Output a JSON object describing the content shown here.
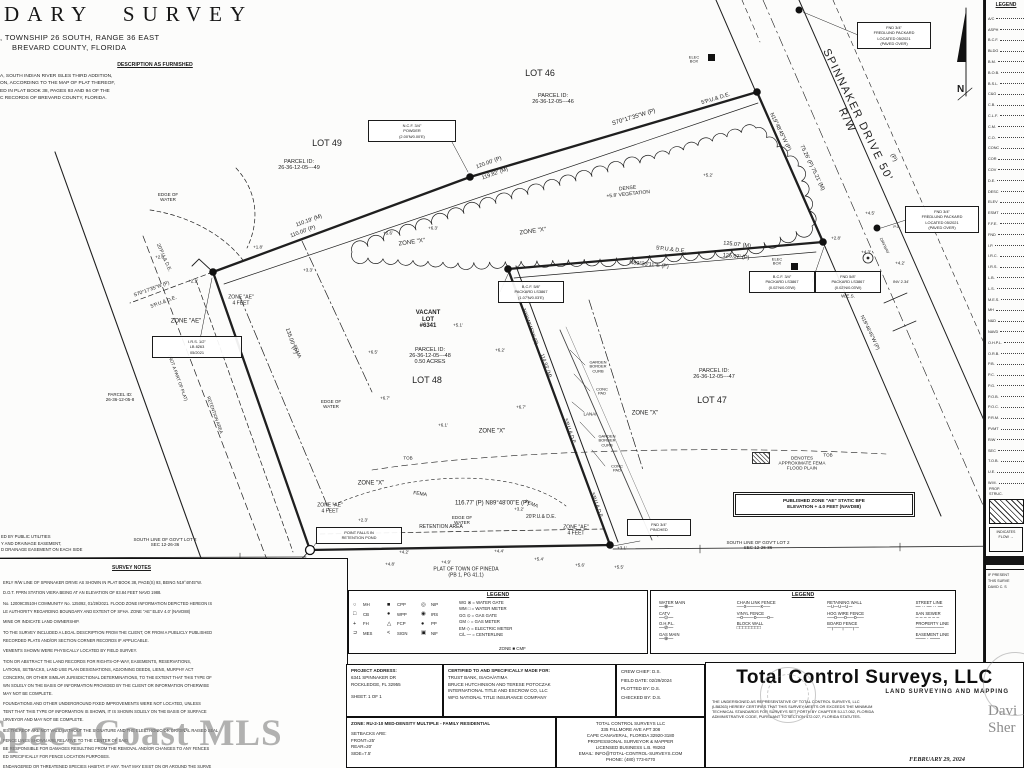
{
  "title_block": {
    "title": "DARY SURVEY",
    "line2": ", TOWNSHIP 26 SOUTH, RANGE 36 EAST",
    "line3": "BREVARD COUNTY, FLORIDA",
    "description_header": "DESCRIPTION AS FURNISHED",
    "description_lines": [
      "A, SOUTH INDIAN RIVER ISLES THIRD ADDITION,",
      "ON, ACCORDING TO THE MAP OF PLAT THEREOF,",
      "ED IN PLAT BOOK 38, PAGES 93 AND 94 OF THE",
      "C RECORDS OF BREVARD COUNTY, FLORIDA."
    ]
  },
  "easement_note_lines": [
    "ED BY PUBLIC UTILITIES",
    "Y AND DRAINAGE EASEMENT,",
    "D DRAINAGE EASEMENT ON EACH SIDE"
  ],
  "north_label": "N",
  "map": {
    "labels": [
      {
        "t": "LOT 46",
        "x": 540,
        "y": 73,
        "s": 9
      },
      {
        "t": "PARCEL ID:\n26-36-12-05---46",
        "x": 553,
        "y": 99,
        "s": 5.5
      },
      {
        "t": "LOT 49",
        "x": 327,
        "y": 143,
        "s": 9
      },
      {
        "t": "PARCEL ID:\n26-36-12-05---49",
        "x": 299,
        "y": 165,
        "s": 5.5
      },
      {
        "t": "LOT 48",
        "x": 427,
        "y": 380,
        "s": 9
      },
      {
        "t": "VACANT\nLOT\n#6341",
        "x": 428,
        "y": 320,
        "s": 6,
        "b": 1
      },
      {
        "t": "PARCEL ID:\n26-36-12-05---48\n0.50 ACRES",
        "x": 430,
        "y": 356,
        "s": 5.5
      },
      {
        "t": "LOT 47",
        "x": 712,
        "y": 400,
        "s": 9
      },
      {
        "t": "PARCEL ID:\n26-36-12-05---47",
        "x": 714,
        "y": 374,
        "s": 5.5
      },
      {
        "t": "SPINNAKER  DRIVE  50' R/W",
        "x": 852,
        "y": 118,
        "s": 11,
        "r": 64,
        "ls": 1.5
      },
      {
        "t": "(P)",
        "x": 893,
        "y": 158,
        "s": 6,
        "r": 64
      },
      {
        "t": "S70°17'35\"W  (P)",
        "x": 634,
        "y": 118,
        "s": 6,
        "r": -17
      },
      {
        "t": "5'P.U.& D.E.",
        "x": 716,
        "y": 99,
        "s": 5.5,
        "r": -17
      },
      {
        "t": "120.00' (P)",
        "x": 489,
        "y": 163,
        "s": 5.5,
        "r": -20
      },
      {
        "t": "119.82' (M)",
        "x": 495,
        "y": 174,
        "s": 5.5,
        "r": -20
      },
      {
        "t": "110.19' (M)",
        "x": 309,
        "y": 221,
        "s": 5.5,
        "r": -20
      },
      {
        "t": "110.00' (P)",
        "x": 303,
        "y": 232,
        "s": 5.5,
        "r": -20
      },
      {
        "t": "S70°17'35\"W (P)",
        "x": 152,
        "y": 290,
        "s": 5,
        "r": -20
      },
      {
        "t": "5'P.U.& D.E.",
        "x": 164,
        "y": 303,
        "s": 5,
        "r": -20
      },
      {
        "t": "N19°48'45\"W (P)",
        "x": 780,
        "y": 132,
        "s": 5.5,
        "r": 64
      },
      {
        "t": "75.26' (P)  75.21' (M)",
        "x": 812,
        "y": 168,
        "s": 5.5,
        "r": 64
      },
      {
        "t": "N19°48'45\"W (P)",
        "x": 869,
        "y": 333,
        "s": 5,
        "r": 64
      },
      {
        "t": "125.07' (M)",
        "x": 737,
        "y": 245,
        "s": 5.5,
        "r": 6
      },
      {
        "t": "5'P.U.& D.E.",
        "x": 671,
        "y": 250,
        "s": 5.5,
        "r": 6
      },
      {
        "t": "N89°33'11\"E (P)",
        "x": 649,
        "y": 265,
        "s": 5.5,
        "r": 6
      },
      {
        "t": "125.07' (P)",
        "x": 736,
        "y": 257,
        "s": 5.5,
        "r": 6
      },
      {
        "t": "N19°48'45\"W (P)",
        "x": 529,
        "y": 327,
        "s": 5,
        "r": 70
      },
      {
        "t": "114.93' (M)",
        "x": 545,
        "y": 366,
        "s": 5,
        "r": 70
      },
      {
        "t": "5'P.U.& D.E.",
        "x": 569,
        "y": 432,
        "s": 5,
        "r": 70
      },
      {
        "t": "5'P.U.& D.E.",
        "x": 596,
        "y": 506,
        "s": 5,
        "r": 70
      },
      {
        "t": "116.77' (P)      N89°48'00\"E  (P)",
        "x": 492,
        "y": 504,
        "s": 6
      },
      {
        "t": "135.00' (P)",
        "x": 291,
        "y": 341,
        "s": 5.5,
        "r": 71
      },
      {
        "t": "20'P.U.& D.E.",
        "x": 163,
        "y": 258,
        "s": 5,
        "r": 66
      },
      {
        "t": "20'P.U.& D.E.",
        "x": 541,
        "y": 518,
        "s": 5
      },
      {
        "t": "+3.2'",
        "x": 519,
        "y": 509,
        "s": 4.5
      },
      {
        "t": "ZONE \"X\"",
        "x": 412,
        "y": 243,
        "s": 6,
        "r": -8
      },
      {
        "t": "ZONE \"X\"",
        "x": 533,
        "y": 232,
        "s": 6,
        "r": -8
      },
      {
        "t": "ZONE \"X\"",
        "x": 492,
        "y": 432,
        "s": 6
      },
      {
        "t": "ZONE \"X\"",
        "x": 645,
        "y": 414,
        "s": 6
      },
      {
        "t": "ZONE \"X\"",
        "x": 371,
        "y": 484,
        "s": 6
      },
      {
        "t": "ZONE \"AE\"",
        "x": 186,
        "y": 322,
        "s": 6
      },
      {
        "t": "ZONE \"AE\"\n4 FEET",
        "x": 241,
        "y": 301,
        "s": 5
      },
      {
        "t": "ZONE \"AE\"\n4 FEET",
        "x": 330,
        "y": 509,
        "s": 5
      },
      {
        "t": "ZONE \"AE\"\n4 FEET",
        "x": 576,
        "y": 531,
        "s": 5
      },
      {
        "t": "FEMA",
        "x": 296,
        "y": 352,
        "s": 5,
        "r": 66
      },
      {
        "t": "FEMA",
        "x": 420,
        "y": 495,
        "s": 5,
        "r": 8
      },
      {
        "t": "FEMA",
        "x": 531,
        "y": 505,
        "s": 5,
        "r": 22
      },
      {
        "t": "RETENTION AREA",
        "x": 441,
        "y": 528,
        "s": 5
      },
      {
        "t": "EDGE OF\nWATER",
        "x": 168,
        "y": 197,
        "s": 4.5
      },
      {
        "t": "EDGE OF\nWATER",
        "x": 331,
        "y": 404,
        "s": 4.5
      },
      {
        "t": "EDGE OF\nWATER",
        "x": 462,
        "y": 520,
        "s": 4.5
      },
      {
        "t": "TOB",
        "x": 408,
        "y": 458,
        "s": 4.5
      },
      {
        "t": "TOB",
        "x": 828,
        "y": 455,
        "s": 4.5
      },
      {
        "t": "(NOT A PART OF PLAT)",
        "x": 178,
        "y": 378,
        "s": 4.5,
        "r": 70
      },
      {
        "t": "RETENTION AREA",
        "x": 215,
        "y": 415,
        "s": 4.5,
        "r": 70
      },
      {
        "t": "PARCEL ID:\n26-36-12-05-8",
        "x": 120,
        "y": 397,
        "s": 4.5
      },
      {
        "t": "SOUTH LINE OF GOV'T LOT 2\nSEC 12-26-36",
        "x": 165,
        "y": 542,
        "s": 4.5
      },
      {
        "t": "SOUTH LINE OF GOV'T LOT 2\nSEC 12-26-36",
        "x": 758,
        "y": 545,
        "s": 4.5
      },
      {
        "t": "PLAT OF TOWN OF PINEDA\n(PB 1, PG 41.1)",
        "x": 466,
        "y": 573,
        "s": 5
      },
      {
        "t": "DENSE\n+5.8' VEGETATION",
        "x": 628,
        "y": 192,
        "s": 5,
        "r": -6
      },
      {
        "t": "+5.2'",
        "x": 708,
        "y": 175,
        "s": 4.5
      },
      {
        "t": "+6.3'",
        "x": 433,
        "y": 228,
        "s": 4.5
      },
      {
        "t": "+5.6'",
        "x": 388,
        "y": 233,
        "s": 4.5
      },
      {
        "t": "+5.1'",
        "x": 458,
        "y": 325,
        "s": 4.5
      },
      {
        "t": "+6.5'",
        "x": 373,
        "y": 352,
        "s": 4.5
      },
      {
        "t": "+6.2'",
        "x": 500,
        "y": 350,
        "s": 4.5
      },
      {
        "t": "+6.7'",
        "x": 385,
        "y": 398,
        "s": 4.5
      },
      {
        "t": "+6.1'",
        "x": 443,
        "y": 425,
        "s": 4.5
      },
      {
        "t": "+6.7'",
        "x": 521,
        "y": 407,
        "s": 4.5
      },
      {
        "t": "+4.2'",
        "x": 404,
        "y": 552,
        "s": 4.5
      },
      {
        "t": "+4.8'",
        "x": 390,
        "y": 564,
        "s": 4.5
      },
      {
        "t": "+4.9'",
        "x": 446,
        "y": 562,
        "s": 4.5
      },
      {
        "t": "+4.4'",
        "x": 499,
        "y": 551,
        "s": 4.5
      },
      {
        "t": "+5.4'",
        "x": 539,
        "y": 559,
        "s": 4.5
      },
      {
        "t": "+5.6'",
        "x": 580,
        "y": 565,
        "s": 4.5
      },
      {
        "t": "+5.5'",
        "x": 619,
        "y": 567,
        "s": 4.5
      },
      {
        "t": "+3.1'",
        "x": 622,
        "y": 548,
        "s": 4.5
      },
      {
        "t": "+2.3'",
        "x": 363,
        "y": 520,
        "s": 4.5
      },
      {
        "t": "+2.0'",
        "x": 160,
        "y": 257,
        "s": 4.5
      },
      {
        "t": "+1.8'",
        "x": 258,
        "y": 247,
        "s": 4.5
      },
      {
        "t": "+3.3'",
        "x": 308,
        "y": 270,
        "s": 4.5
      },
      {
        "t": "+2.1'",
        "x": 193,
        "y": 281,
        "s": 4.5
      },
      {
        "t": "+4.5'",
        "x": 870,
        "y": 213,
        "s": 4.5
      },
      {
        "t": "+2.8'",
        "x": 836,
        "y": 238,
        "s": 4.5
      },
      {
        "t": "+4.3'",
        "x": 866,
        "y": 252,
        "s": 4.5
      },
      {
        "t": "+4.2'",
        "x": 900,
        "y": 263,
        "s": 4.5
      },
      {
        "t": "ELEC\nBOX",
        "x": 694,
        "y": 60,
        "s": 4
      },
      {
        "t": "ELEC\nBOX",
        "x": 777,
        "y": 262,
        "s": 4
      },
      {
        "t": "W.E.S.",
        "x": 848,
        "y": 296,
        "s": 4.5
      },
      {
        "t": "INV 2.34'",
        "x": 901,
        "y": 282,
        "s": 4
      },
      {
        "t": "P.C.",
        "x": 897,
        "y": 227,
        "s": 4
      },
      {
        "t": "DRVWAY",
        "x": 884,
        "y": 246,
        "s": 4,
        "r": 64
      },
      {
        "t": "GARDEN\nBORDER\nCURB",
        "x": 598,
        "y": 367,
        "s": 4
      },
      {
        "t": "CONC\nPAD",
        "x": 602,
        "y": 392,
        "s": 4
      },
      {
        "t": "LANAI",
        "x": 590,
        "y": 414,
        "s": 4.5
      },
      {
        "t": "GARDEN\nBORDER\nCURB",
        "x": 607,
        "y": 441,
        "s": 4
      },
      {
        "t": "CONC\nPAD",
        "x": 617,
        "y": 469,
        "s": 4
      },
      {
        "t": "DENOTES\nAPPROXIMATE FEMA\nFLOOD PLAIN",
        "x": 802,
        "y": 463,
        "s": 4.6
      },
      {
        "t": "2.5'W",
        "x": 296,
        "y": 561,
        "s": 4
      }
    ],
    "boxes": [
      {
        "x": 368,
        "y": 120,
        "w": 84,
        "txt": "N.C.F. 3/4\"\nPOWDER\n(2.00'N/0.00'E)"
      },
      {
        "x": 152,
        "y": 336,
        "w": 86,
        "txt": "I.R.S. 1/2\"\nLB 8263\n05/2021"
      },
      {
        "x": 857,
        "y": 22,
        "w": 70,
        "txt": "FND 3/4\"\nFREDLUND PACKARD\nLOCATED 05/2021\n(PAVED OVER)"
      },
      {
        "x": 905,
        "y": 206,
        "w": 70,
        "txt": "FND 3/4\"\nFREDLUND PACKARD\nLOCATED 05/2021\n(PAVED OVER)"
      },
      {
        "x": 749,
        "y": 271,
        "w": 62,
        "txt": "B.C.F. 3/4\"\nPACKARD LS3867\n(0.02'N/0.03'W)"
      },
      {
        "x": 815,
        "y": 271,
        "w": 62,
        "txt": "FND 5/8\"\nPACKARD LS3867\n(0.02'N/0.03'W)"
      },
      {
        "x": 498,
        "y": 281,
        "w": 62,
        "txt": "B.C.F. 5/8\"\nPACKARD LS3867\n(1.07'N/0.03'E)"
      },
      {
        "x": 316,
        "y": 527,
        "w": 82,
        "txt": "POINT FALLS IN\nRETENTION POND"
      },
      {
        "x": 627,
        "y": 519,
        "w": 60,
        "txt": "FND 3/4\"\nPINCHED"
      }
    ],
    "published_zone_note": {
      "x": 735,
      "y": 494,
      "w": 172,
      "txt": "PUBLISHED ZONE \"AE\" STATIC BFE\nELEVATION + 4.0 FEET (NAVD88)"
    }
  },
  "legend_symbols": {
    "header": "LEGEND",
    "sym_cols": [
      [
        [
          "○",
          "MH"
        ],
        [
          "□",
          "CB"
        ],
        [
          "+",
          "FH"
        ],
        [
          "⊃",
          "MES"
        ]
      ],
      [
        [
          "■",
          "CPP"
        ],
        [
          "●",
          "WPP"
        ],
        [
          "△",
          "FCP"
        ],
        [
          "<",
          "SIGN"
        ]
      ],
      [
        [
          "◎",
          "NIP"
        ],
        [
          "◉",
          "IRS"
        ],
        [
          "●",
          "PP"
        ],
        [
          "▣",
          "NIF"
        ]
      ]
    ],
    "defs": [
      "WG ⊗ = WATER GATE",
      "WM □ = WATER METER",
      "GG ⊙ = GAS GATE",
      "GM ○ = GAS METER",
      "EM ◇ = ELECTRIC METER",
      "C/L — = CENTERLINE"
    ],
    "zone_row": "ZONE  ■  CMF"
  },
  "legend_lines": {
    "header": "LEGEND",
    "cols": [
      [
        {
          "l": "WATER MAIN",
          "g": "—⊗—"
        },
        {
          "l": "CATV",
          "g": "—⊙—"
        },
        {
          "l": "O.H.P.L.",
          "g": "—⊘—"
        },
        {
          "l": "GAS MAIN",
          "g": "—⊕—"
        }
      ],
      [
        {
          "l": "CHAIN LINK FENCE",
          "g": "──x────x──"
        },
        {
          "l": "VINYL FENCE",
          "g": "─o───o───o─"
        },
        {
          "l": "BLOCK WALL",
          "g": "□□□□□□□□"
        }
      ],
      [
        {
          "l": "RETAINING WALL",
          "g": "─∪─∪─∪─"
        },
        {
          "l": "HOG WIRE FENCE",
          "g": "──o──o──o──"
        },
        {
          "l": "BOARD FENCE",
          "g": "─┬──┬──┬─"
        }
      ],
      [
        {
          "l": "STREET LINE",
          "g": "— ·· — ·· —"
        },
        {
          "l": "SAN SEWER",
          "g": "– – – – – –"
        },
        {
          "l": "PROPERTY LINE",
          "g": "────────"
        },
        {
          "l": "EASEMENT LINE",
          "g": "—— · ——"
        }
      ]
    ]
  },
  "right_column": {
    "header": "LEGEND",
    "abbreviations": [
      "A/C",
      "ASPH",
      "B.C.F.",
      "BLDG",
      "B.M.",
      "B.O.B.",
      "B.S.L.",
      "C&G",
      "C.B.",
      "C.L.F.",
      "C.M.",
      "C.O.",
      "CONC",
      "COR",
      "COV",
      "D.E.",
      "DESC",
      "ELEV",
      "ESMT",
      "F.F.E.",
      "FND",
      "I.P.",
      "I.R.C.",
      "I.R.S.",
      "L.B.",
      "L.S.",
      "M.E.S.",
      "MH",
      "N&D",
      "NAVD",
      "O.H.P.L.",
      "O.R.B.",
      "P.B.",
      "P.C.",
      "P.G.",
      "P.O.B.",
      "P.O.C.",
      "P.R.M.",
      "PVMT",
      "R/W",
      "SEC",
      "T.O.B.",
      "U.E.",
      "W.M."
    ],
    "proposed_structure_lines": [
      "PROP.",
      "STRUC."
    ],
    "flow_lines": [
      "INDICATES",
      "FLOW →"
    ],
    "cert_fragment_lines": [
      "IF PRESENT",
      "THIS SURVE",
      "DAVID C. S"
    ]
  },
  "notes": {
    "header": "SURVEY NOTES",
    "paragraphs": [
      [
        "ERLY R/W LINE OF SPINNAKER DRIVE AS SHOWN IN PLAT BOOK 38, PAGE(S) 93, BEING N19°48'45\"W."
      ],
      [
        "D.O.T. FPRN STATION VIERA BEING AT AN ELEVATION OF 83.84 FEET NAVD 1988."
      ],
      [
        "No. 12009C0510H COMMUNITY No. 125092, 01/29/2021. FLOOD ZONE INFORMATION DEPICTED HEREON IS",
        "LE AUTHORITY REGARDING BOUNDARY AND EXTENT OF SFHA. ZONE \"AE\" ELEV 4.0' (NAVD88)"
      ],
      [
        "MINE OR INDICATE LAND OWNERSHIP."
      ],
      [
        "TO THE SURVEY INCLUDED A LEGAL DESCRIPTION FROM THE CLIENT, OR FROM A PUBLICLY PUBLISHED",
        "RECORDED PLATS AND/OR SECTION CORNER RECORDS IF APPLICABLE."
      ],
      [
        "VEMENTS SHOWN WERE PHYSICALLY LOCATED BY FIELD SURVEY."
      ],
      [
        "TION OR ABSTRACT THE LAND RECORDS FOR RIGHTS-OF-WAY, EASEMENTS, RESERVATIONS,",
        "LATIONS, SETBACKS, LAND USE PLAN DESIGNATIONS, ADJOINING DEEDS, LIENS, MURPHY ACT",
        "CONCERN, OR OTHER SIMILAR JURISDICTIONAL DETERMINATIONS, TO THE EXTENT THAT THIS TYPE OF",
        "WN SOLELY ON THE BASIS OF INFORMATION PROVIDED BY THE CLIENT OR INFORMATION OTHERWISE",
        "MAY NOT BE COMPLETE."
      ],
      [
        "FOUNDATIONS AND OTHER UNDERGROUND FIXED IMPROVEMENTS WERE NOT LOCATED, UNLESS",
        "TENT THAT THIS TYPE OF INFORMATION IS SHOWN, IT IS SHOWN SOLELY ON THE BASIS OF SURFACE",
        "URVEYOR AND MAY NOT BE COMPLETE."
      ],
      [
        "IES THEREOF ARE NOT VALID WITHOUT THE SIGNATURE AND THE ELECTRONIC OR ORIGINAL RAISED SEAL"
      ],
      [
        "FENCE LINES SHOWN ARE RELATIVE TO THE CENTER OF SAID",
        "BE RESPONSIBLE FOR DAMAGES RESULTING FROM THE REMOVAL AND/OR CHANGES TO ANY FENCES",
        "ED SPECIFICALLY FOR FENCE LOCATION PURPOSES."
      ],
      [
        "ENDANGERED OR THREATENED SPECIES HABITAT, IF ANY, THAT MAY EXIST ON OR AROUND THE SURVE"
      ]
    ]
  },
  "info_blocks": {
    "project": {
      "header": "PROJECT ADDRESS:",
      "lines": [
        "6341 SPINNAKER DR",
        "ROCKLEDGE, FL 32955"
      ],
      "sheet": "SHEET: 1 OF 1"
    },
    "certified": {
      "header": "CERTIFIED TO AND SPECIFICALLY MADE FOR:",
      "lines": [
        "TRUST BANK, ISAOA/ATIMA",
        "BRUCE HUTCHINSON AND TERESE POTOCZAK",
        "INTERNATIONAL TITLE AND ESCROW CO, LLC",
        "WFG NATIONAL TITLE INSURANCE COMPANY"
      ]
    },
    "crew": {
      "lines": [
        "CREW CHIEF: D.S.",
        "FIELD DATE: 02/29/2024",
        "PLOTTED BY: D.S.",
        "CHECKED BY: D.S."
      ]
    },
    "zoning": {
      "header": "ZONE: RU-2-10 MED-DENSITY MULTIPLE - FAMILY RESIDENTIAL",
      "lines": [
        "SETBACKS ARE:",
        "FRONT=25'",
        "REAR=20'",
        "SIDE=7.5'"
      ]
    },
    "company": {
      "lines": [
        "TOTAL CONTROL SURVEYS LLC",
        "335 FILLMORE AVE  APT 308",
        "CAPE CANAVERAL, FLORIDA 32920-3180",
        "PROFESSIONAL SURVEYOR & MAPPER",
        "LICENSED BUSINESS L.B. #8263",
        "EMAIL: INFO@TOTAL-CONTROL-SURVEYS.COM",
        "PHONE: (480) 773-6770"
      ]
    },
    "firm": {
      "name": "Total Control Surveys, LLC",
      "tagline": "LAND SURVEYING AND MAPPING",
      "cert_lines": [
        "THE UNDERSIGNED AS REPRESENTATIVE OF TOTAL CONTROL SURVEYS, LLC",
        "(LB8263) HEREBY CERTIFIES THAT THIS SURVEY MEETS OR EXCEEDS THE MINIMUM",
        "TECHNICAL STANDARDS FOR SURVEYS SET FORTH BY CHAPTER 5J-17.052, FLORIDA",
        "ADMINISTRATIVE CODE, PURSUANT TO SECTION 472.027, FLORIDA STATUTES."
      ],
      "date": "FEBRUARY 29, 2024"
    }
  },
  "watermarks": {
    "mls": "Space Coast MLS",
    "agent_lines": [
      "Davi",
      "Sher"
    ]
  }
}
